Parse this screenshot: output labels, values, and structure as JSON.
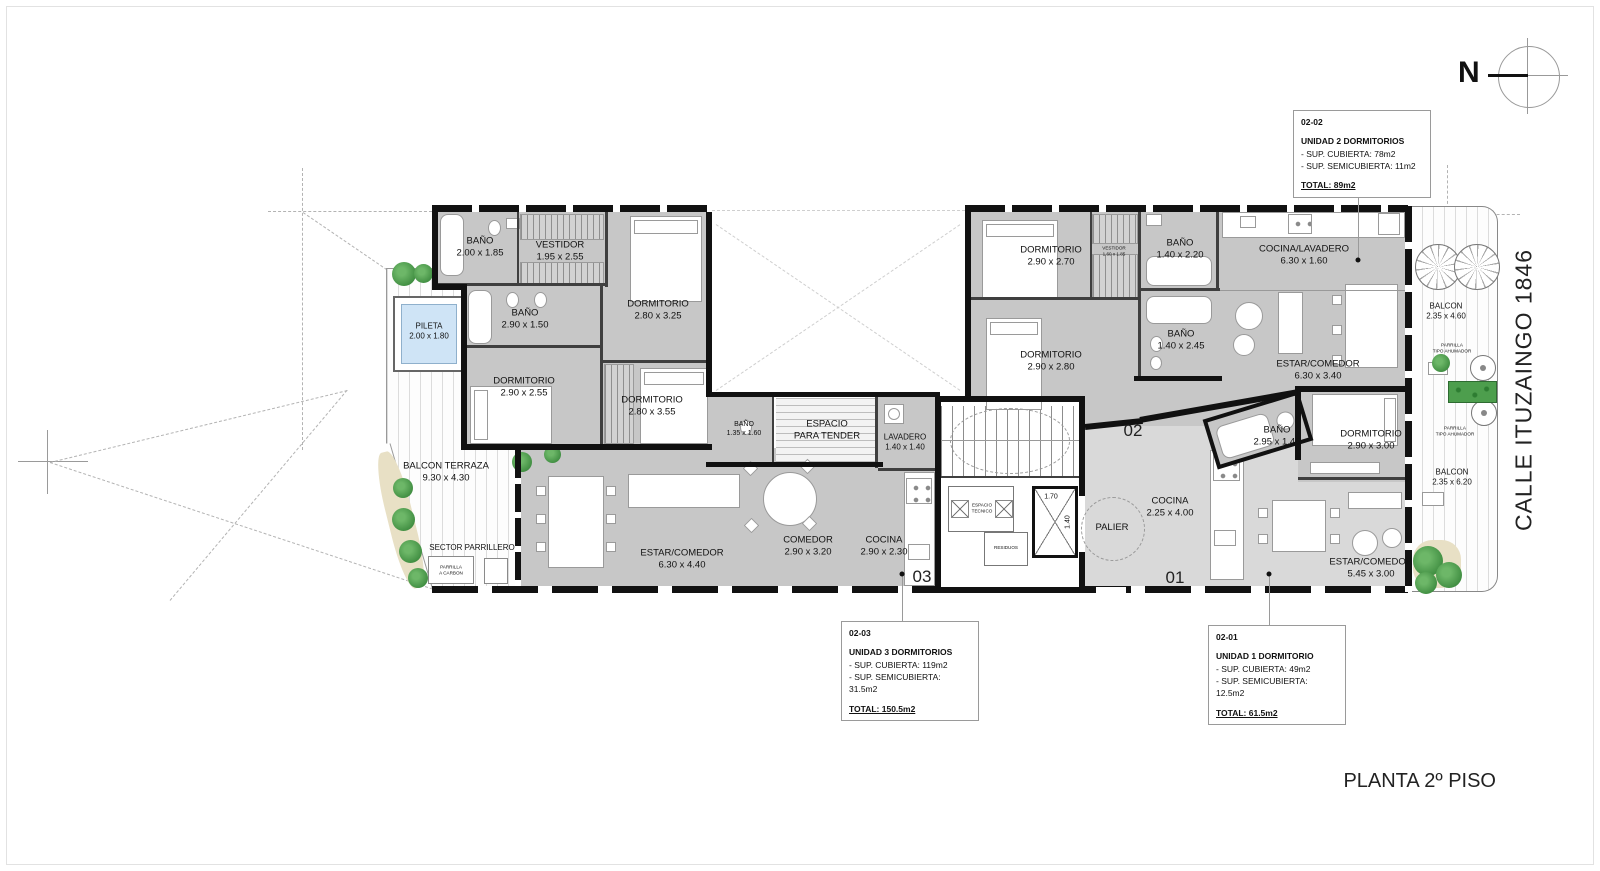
{
  "titles": {
    "plan": "PLANTA 2º PISO",
    "street": "CALLE ITUZAINGO 1846",
    "north": "N"
  },
  "info_boxes": [
    {
      "code": "02-02",
      "name": "UNIDAD 2 DORMITORIOS",
      "covered": "- SUP. CUBIERTA: 78m2",
      "semi": "- SUP. SEMICUBIERTA: 11m2",
      "total": "TOTAL: 89m2"
    },
    {
      "code": "02-03",
      "name": "UNIDAD 3 DORMITORIOS",
      "covered": "- SUP. CUBIERTA: 119m2",
      "semi": "- SUP. SEMICUBIERTA: 31.5m2",
      "total": "TOTAL: 150.5m2"
    },
    {
      "code": "02-01",
      "name": "UNIDAD 1 DORMITORIO",
      "covered": "- SUP. CUBIERTA: 49m2",
      "semi": "- SUP. SEMICUBIERTA: 12.5m2",
      "total": "TOTAL: 61.5m2"
    }
  ],
  "unit_markers": {
    "u1": "01",
    "u2": "02",
    "u3": "03"
  },
  "dims": {
    "elev_w": "1.70",
    "elev_d": "1.40"
  },
  "rooms": {
    "u3_bano1": {
      "label": "BAÑO",
      "dim": "2.00 x 1.85"
    },
    "u3_vestidor": {
      "label": "VESTIDOR",
      "dim": "1.95 x 2.55"
    },
    "u3_dorm1": {
      "label": "DORMITORIO",
      "dim": "2.80 x 3.25"
    },
    "u3_bano2": {
      "label": "BAÑO",
      "dim": "2.90 x 1.50"
    },
    "u3_dorm2": {
      "label": "DORMITORIO",
      "dim": "2.90 x 2.55"
    },
    "u3_dorm3": {
      "label": "DORMITORIO",
      "dim": "2.80 x 3.55"
    },
    "u3_bano3": {
      "label": "BAÑO",
      "dim": "1.35 x 1.60"
    },
    "u3_tender": {
      "label": "ESPACIO",
      "dim": "PARA TENDER"
    },
    "u3_lavadero": {
      "label": "LAVADERO",
      "dim": "1.40 x 1.40"
    },
    "u3_estar": {
      "label": "ESTAR/COMEDOR",
      "dim": "6.30 x 4.40"
    },
    "u3_comedor": {
      "label": "COMEDOR",
      "dim": "2.90 x 3.20"
    },
    "u3_cocina": {
      "label": "COCINA",
      "dim": "2.90 x 2.30"
    },
    "pileta": {
      "label": "PILETA",
      "dim": "2.00 x 1.80"
    },
    "balcon_terraza": {
      "label": "BALCON TERRAZA",
      "dim": "9.30 x 4.30"
    },
    "sector_parrillero": {
      "label": "SECTOR PARRILLERO",
      "dim": ""
    },
    "parrilla_carbon": {
      "label": "PARRILLA",
      "dim": "A CARBON"
    },
    "u2_dorm1": {
      "label": "DORMITORIO",
      "dim": "2.90 x 2.70"
    },
    "u2_vestidor": {
      "label": "VESTIDOR",
      "dim": "1.60 x 1.85"
    },
    "u2_bano1": {
      "label": "BAÑO",
      "dim": "1.40 x 2.20"
    },
    "u2_bano2": {
      "label": "BAÑO",
      "dim": "1.40 x 2.45"
    },
    "u2_dorm2": {
      "label": "DORMITORIO",
      "dim": "2.90 x 2.80"
    },
    "u2_cocina": {
      "label": "COCINA/LAVADERO",
      "dim": "6.30 x 1.60"
    },
    "u2_estar": {
      "label": "ESTAR/COMEDOR",
      "dim": "6.30 x 3.40"
    },
    "balcon_u2": {
      "label": "BALCON",
      "dim": "2.35 x 4.60"
    },
    "u1_bano": {
      "label": "BAÑO",
      "dim": "2.95 x 1.45"
    },
    "u1_dorm": {
      "label": "DORMITORIO",
      "dim": "2.90 x 3.00"
    },
    "u1_cocina": {
      "label": "COCINA",
      "dim": "2.25 x 4.00"
    },
    "u1_estar": {
      "label": "ESTAR/COMEDOR",
      "dim": "5.45 x 3.00"
    },
    "balcon_u1": {
      "label": "BALCON",
      "dim": "2.35 x 6.20"
    },
    "esp_tecnico": {
      "label": "ESPACIO",
      "dim": "TECNICO"
    },
    "residuos": {
      "label": "RESIDUOS",
      "dim": ""
    },
    "palier": {
      "label": "PALIER",
      "dim": ""
    },
    "ahumador1": {
      "label": "PARRILLA",
      "dim": "TIPO AHUMADOR"
    },
    "ahumador2": {
      "label": "PARRILLA",
      "dim": "TIPO AHUMADOR"
    }
  }
}
